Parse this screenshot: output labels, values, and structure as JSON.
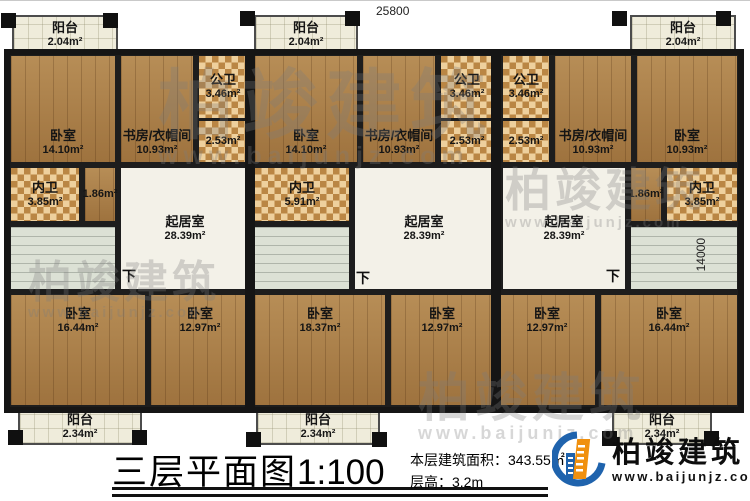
{
  "dims": {
    "top": "25800",
    "right": "14000"
  },
  "stairs": {
    "down": "下"
  },
  "rooms": {
    "balcony_t1": {
      "name": "阳台",
      "area": "2.04m²"
    },
    "balcony_t2": {
      "name": "阳台",
      "area": "2.04m²"
    },
    "balcony_t3": {
      "name": "阳台",
      "area": "2.04m²"
    },
    "bedroom_t1": {
      "name": "卧室",
      "area": "14.10m²"
    },
    "bedroom_t2": {
      "name": "卧室",
      "area": "14.10m²"
    },
    "bedroom_t3": {
      "name": "卧室",
      "area": "10.93m²"
    },
    "study1": {
      "name": "书房/衣帽间",
      "area": "10.93m²"
    },
    "study2": {
      "name": "书房/衣帽间",
      "area": "10.93m²"
    },
    "study3": {
      "name": "书房/衣帽间",
      "area": "10.93m²"
    },
    "pubbath1": {
      "name": "公卫",
      "area": "3.46m²"
    },
    "pubbath2": {
      "name": "公卫",
      "area": "3.46m²"
    },
    "pubbath3": {
      "name": "公卫",
      "area": "3.46m²"
    },
    "store1": {
      "area": "2.53m²"
    },
    "store2": {
      "area": "2.53m²"
    },
    "store3": {
      "area": "2.53m²"
    },
    "privbath1": {
      "name": "内卫",
      "area": "3.85m²"
    },
    "privbath2": {
      "name": "内卫",
      "area": "5.91m²"
    },
    "privbath3": {
      "name": "内卫",
      "area": "3.85m²"
    },
    "hall1": {
      "area": "1.86m²"
    },
    "hall3": {
      "area": "1.86m²"
    },
    "living1": {
      "name": "起居室",
      "area": "28.39m²"
    },
    "living2": {
      "name": "起居室",
      "area": "28.39m²"
    },
    "living3": {
      "name": "起居室",
      "area": "28.39m²"
    },
    "bedroom_b1a": {
      "name": "卧室",
      "area": "16.44m²"
    },
    "bedroom_b1b": {
      "name": "卧室",
      "area": "12.97m²"
    },
    "bedroom_b2a": {
      "name": "卧室",
      "area": "18.37m²"
    },
    "bedroom_b2b": {
      "name": "卧室",
      "area": "12.97m²"
    },
    "bedroom_b3a": {
      "name": "卧室",
      "area": "12.97m²"
    },
    "bedroom_b3b": {
      "name": "卧室",
      "area": "16.44m²"
    },
    "balcony_b1": {
      "name": "阳台",
      "area": "2.34m²"
    },
    "balcony_b2": {
      "name": "阳台",
      "area": "2.34m²"
    },
    "balcony_b3": {
      "name": "阳台",
      "area": "2.34m²"
    }
  },
  "titleblock": {
    "title": "三层平面图",
    "scale": "1:100",
    "area_label": "本层建筑面积：",
    "area_value": "343.55㎡",
    "height_label": "层高：",
    "height_value": "3.2m"
  },
  "logo": {
    "name": "柏竣建筑",
    "url": "www.baijunjz.com"
  },
  "watermark": {
    "text": "柏竣建筑",
    "url": "www.baijunjz.com"
  }
}
